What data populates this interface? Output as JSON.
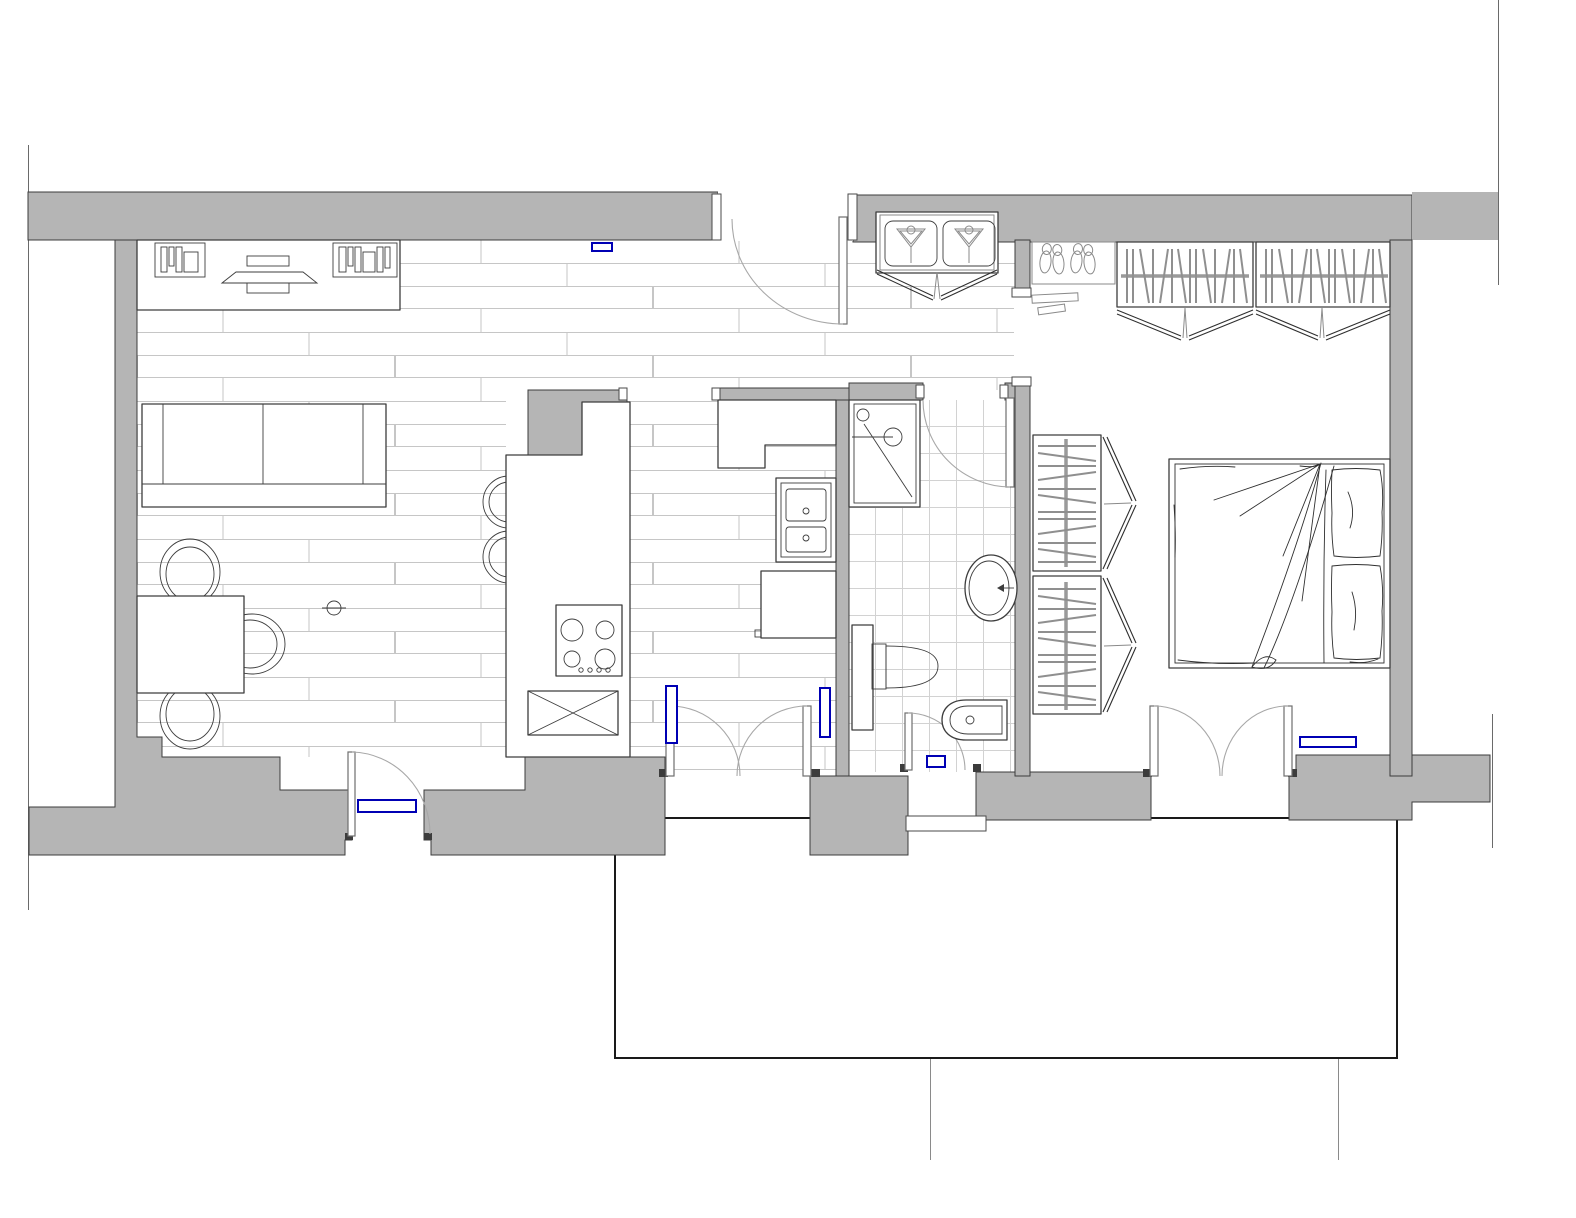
{
  "title": "Apartment floor plan",
  "colors": {
    "c-wall": "#b5b5b5",
    "c-wallline": "#3c3c3c",
    "c-furniture": "#3d3d3d",
    "c-plank": "#c6c6c6",
    "c-tile": "#d2d2d2",
    "c-arc": "#a8a8a8",
    "c-radiator": "#0000b4",
    "c-hang": "#8f8f8f",
    "c-bg": "#ffffff",
    "c-outline": "#6a6a6a"
  },
  "rooms": [
    {
      "id": "living-room",
      "floor": "wood-planks",
      "furniture": [
        "media-console",
        "tv",
        "bookshelf-left",
        "bookshelf-right",
        "sofa",
        "dining-table",
        "dining-chairs",
        "ceiling-light",
        "balcony-door",
        "radiator"
      ]
    },
    {
      "id": "kitchen",
      "floor": "wood-planks",
      "furniture": [
        "peninsula-counter",
        "bar-stools",
        "cooktop",
        "base-unit-crossed",
        "top-counter",
        "double-sink",
        "refrigerator",
        "french-doors",
        "radiators"
      ]
    },
    {
      "id": "hallway",
      "floor": "wood-planks",
      "furniture": [
        "entrance-door",
        "laundry-closet",
        "washer",
        "dryer",
        "radiator"
      ]
    },
    {
      "id": "bathroom",
      "floor": "ceramic-tiles",
      "furniture": [
        "shower",
        "washbasin",
        "toilet",
        "tall-cabinet",
        "bidet",
        "entry-door",
        "service-door",
        "radiator"
      ]
    },
    {
      "id": "bedroom",
      "floor": "plain",
      "furniture": [
        "double-bed",
        "pillows",
        "wardrobe-top-1",
        "wardrobe-top-2",
        "wardrobe-side-1",
        "wardrobe-side-2",
        "shoe-rack",
        "doormat",
        "french-doors",
        "radiator"
      ]
    },
    {
      "id": "courtyard",
      "floor": "plain",
      "furniture": [
        "threshold"
      ]
    }
  ],
  "counts": {
    "dining_chairs": 3,
    "bar_stools": 2,
    "cooktop_burners": 4,
    "wardrobes": 4,
    "shoes_on_rack": 4,
    "laundry_machines": 2,
    "radiators": 6,
    "exterior_french_doors": 2,
    "swing_doors": 5
  }
}
